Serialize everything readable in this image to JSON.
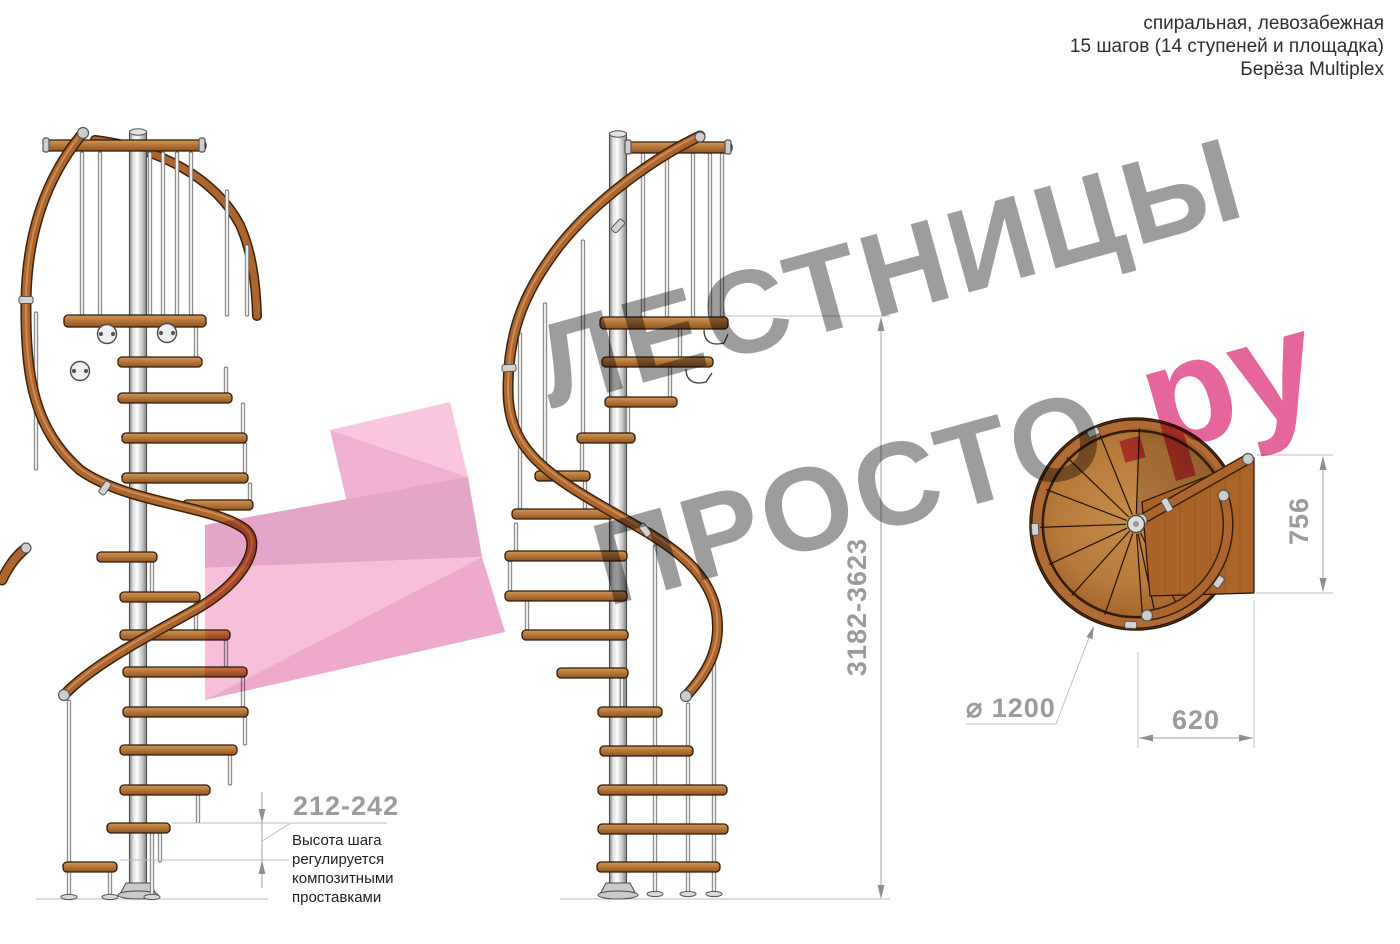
{
  "header": {
    "line1": "спиральная, левозабежная",
    "line2": "15 шагов (14 ступеней и площадка)",
    "line3": "Берёза Multiplex"
  },
  "watermark": {
    "line1": "ЛЕСТНИЦЫ",
    "line2": "ПРОСТО",
    "suffix": ".ру",
    "text_color": "#9d9d9d",
    "accent_color": "#e4669c"
  },
  "dimensions": {
    "total_height": "3182-3623",
    "landing_depth": "756",
    "landing_width": "620",
    "diameter": "⌀ 1200",
    "step_rise": "212-242"
  },
  "note": {
    "line1": "Высота шага",
    "line2": "регулируется",
    "line3": "композитными",
    "line4": "проставками"
  },
  "colors": {
    "wood": "#ad6530",
    "wood_light": "#d6985c",
    "pole_metal": "#cfcfcf",
    "dimension_gray": "#9b9b9b",
    "pink_arrow": "#f3b8d8",
    "background": "#ffffff"
  }
}
